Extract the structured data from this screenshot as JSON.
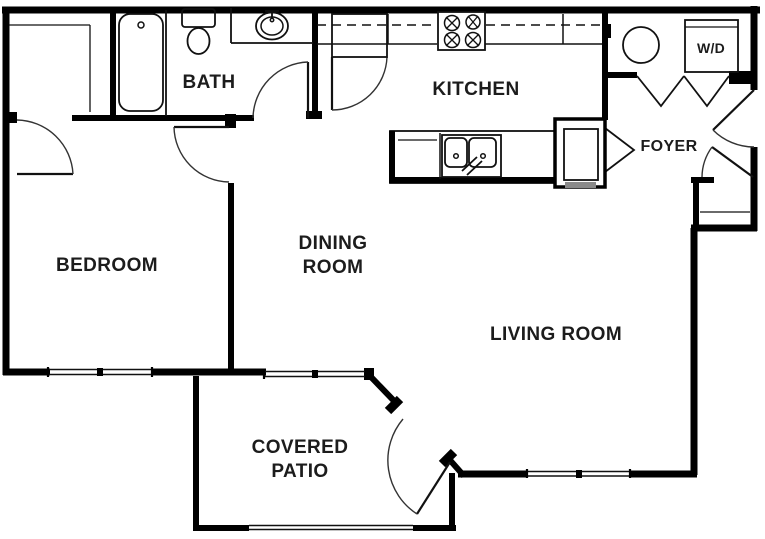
{
  "title": "apartment-floor-plan",
  "colors": {
    "wall": "#000000",
    "background": "#ffffff",
    "label": "#1c1c1c",
    "cabinet_shade": "#8a8a8a"
  },
  "rooms": {
    "bedroom": {
      "label": "BEDROOM"
    },
    "bath": {
      "label": "BATH"
    },
    "kitchen": {
      "label": "KITCHEN"
    },
    "dining": {
      "label_line1": "DINING",
      "label_line2": "ROOM"
    },
    "living": {
      "label": "LIVING ROOM"
    },
    "foyer": {
      "label": "FOYER"
    },
    "patio": {
      "label_line1": "COVERED",
      "label_line2": "PATIO"
    },
    "laundry": {
      "label": "W/D"
    }
  }
}
